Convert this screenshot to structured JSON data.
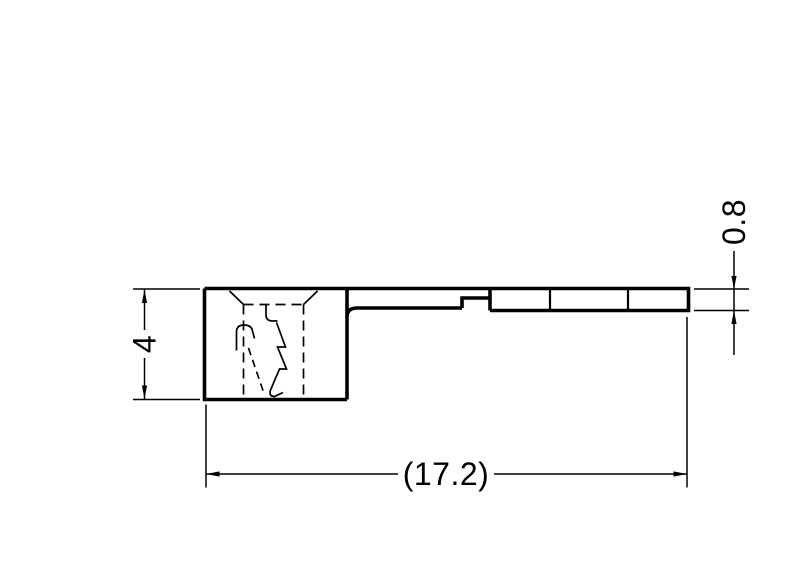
{
  "drawing": {
    "kind": "technical-dimension-drawing",
    "labels": {
      "height": "4",
      "thickness": "0.8",
      "overall_length": "(17.2)"
    },
    "colors": {
      "line": "#000000",
      "background": "#ffffff"
    }
  }
}
